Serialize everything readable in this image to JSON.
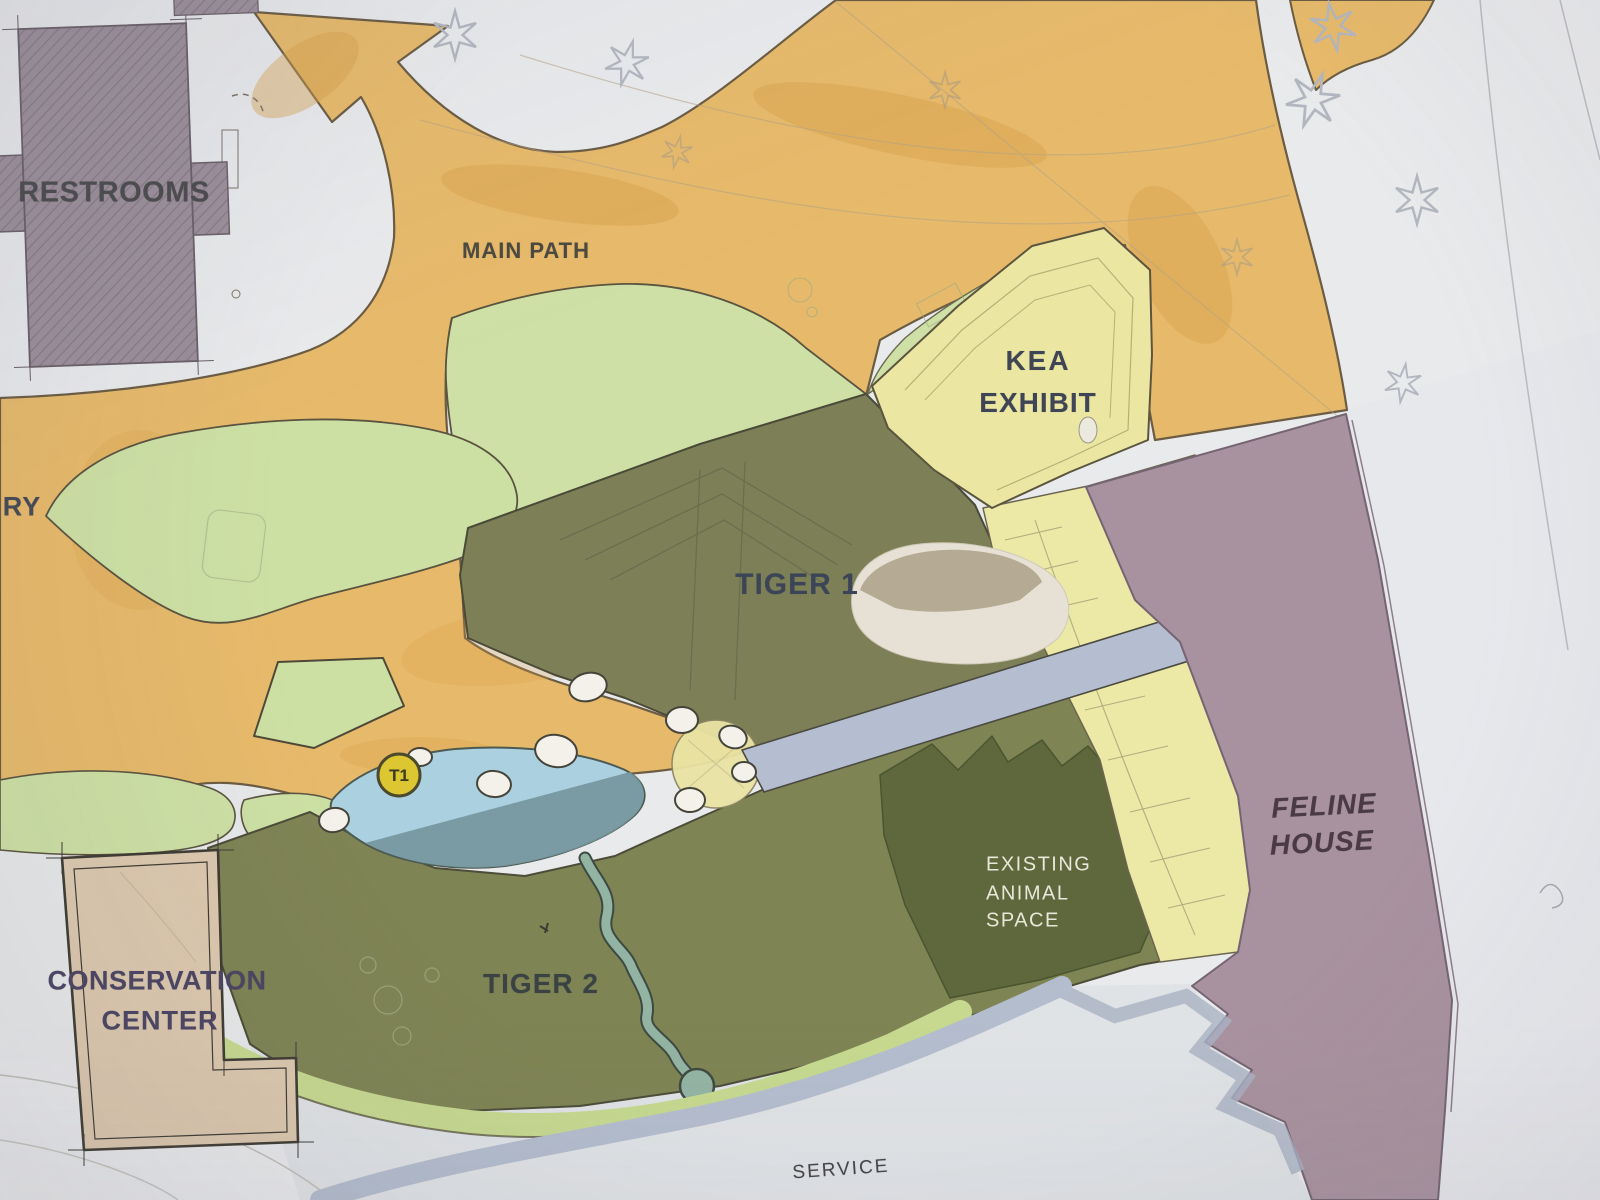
{
  "labels": {
    "restrooms": "RESTROOMS",
    "main_path": "MAIN PATH",
    "kea_line1": "KEA",
    "kea_line2": "EXHIBIT",
    "tiger1": "TIGER 1",
    "tiger2": "TIGER 2",
    "conservation_line1": "CONSERVATION",
    "conservation_line2": "CENTER",
    "feline_line1": "FELINE",
    "feline_line2": "HOUSE",
    "existing_line1": "EXISTING",
    "existing_line2": "ANIMAL",
    "existing_line3": "SPACE",
    "service": "SERVICE",
    "aviary_partial": "RY",
    "t1_marker": "T1"
  },
  "colors": {
    "path_orange": "#e7ba6b",
    "lawn_green": "#cfe0a6",
    "tiger_enclosure_olive": "#7d8057",
    "existing_animal_space_olive": "#5e683c",
    "kea_yellow": "#ebe7a2",
    "feline_house_mauve": "#a9929f",
    "conservation_center_tan": "#dcc8ae",
    "restrooms_grey": "#9b8f9a",
    "pond_blue": "#abd1e0",
    "walkway_blue_grey": "#b5bed0",
    "t1_marker_yellow": "#dcc733",
    "paper_white": "#e9eaec"
  }
}
